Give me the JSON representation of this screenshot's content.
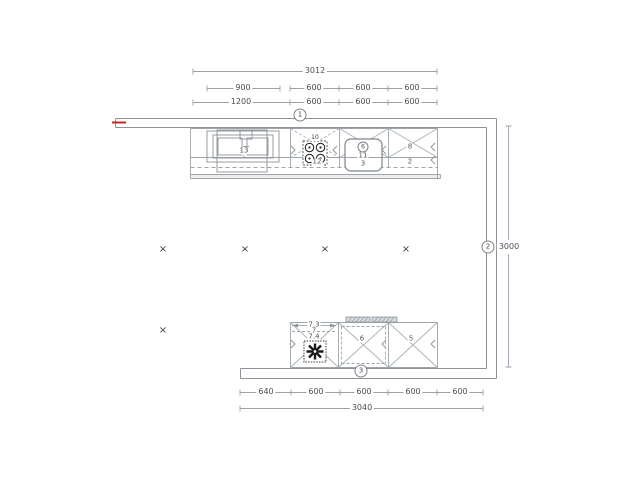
{
  "document": {
    "type": "kitchen-floor-plan"
  },
  "colors": {
    "line": "#9aa0a5",
    "wall": "#8b9196",
    "text": "#4a4f54",
    "accent_red": "#c4281e",
    "symbol_black": "#17191b"
  },
  "markers": {
    "cross": "×"
  },
  "badges": {
    "pos1": "1",
    "pos2": "2",
    "pos3": "3",
    "item6": "6"
  },
  "dims": {
    "top1": "3012",
    "top2": [
      "900",
      "600",
      "600",
      "600"
    ],
    "top3": [
      "1200",
      "600",
      "600",
      "600"
    ],
    "right": "3000",
    "bottom1": [
      "640",
      "600",
      "600",
      "600",
      "600"
    ],
    "bottom2": "3040"
  },
  "items": {
    "sink": "13",
    "hob_top": "10",
    "hob": "12",
    "mid_a": "11",
    "mid_b": "3",
    "right_a": "8",
    "right_b": "2",
    "low_left_a": "7.3",
    "low_left_b": "7",
    "low_left_c": "7.4",
    "low_mid": "6",
    "low_right": "5"
  }
}
